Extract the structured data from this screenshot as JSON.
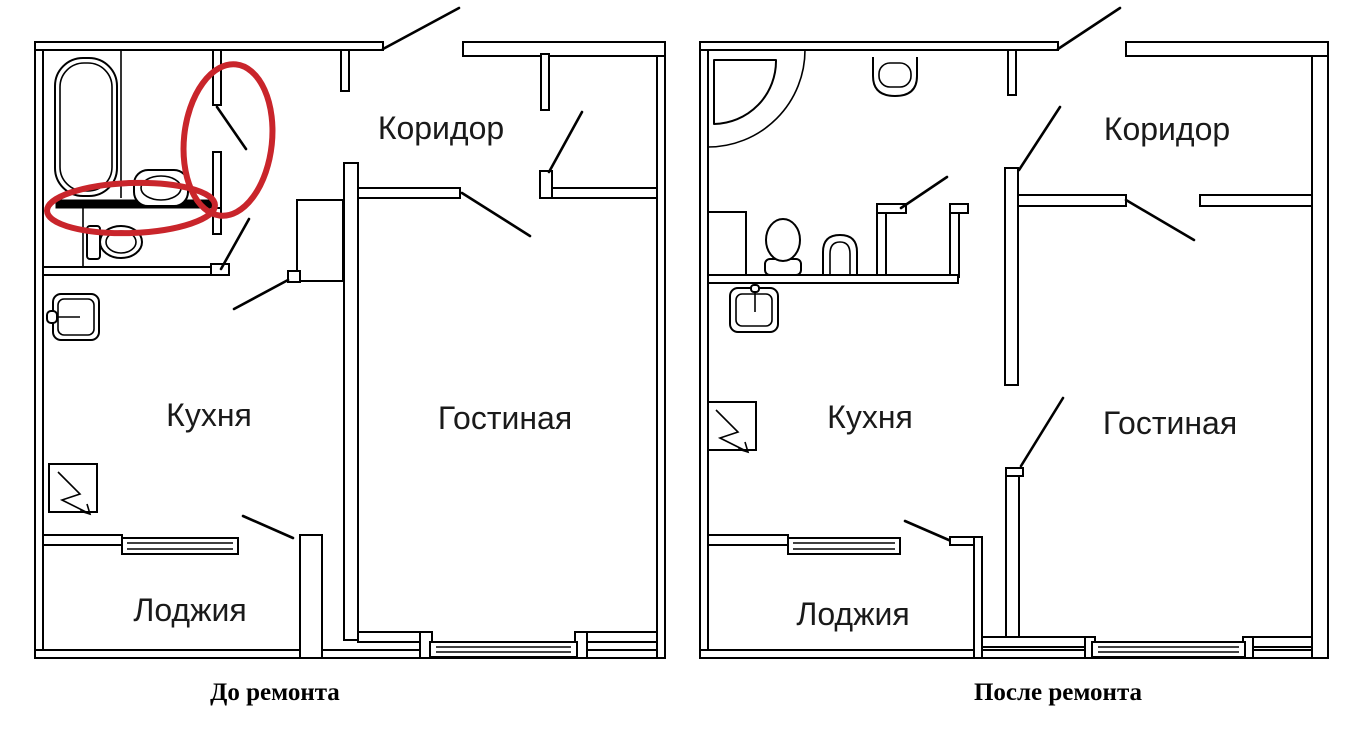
{
  "plans": {
    "before": {
      "caption": "До ремонта",
      "rooms": {
        "corridor": "Коридор",
        "kitchen": "Кухня",
        "living": "Гостиная",
        "loggia": "Лоджия"
      }
    },
    "after": {
      "caption": "После ремонта",
      "rooms": {
        "corridor": "Коридор",
        "kitchen": "Кухня",
        "living": "Гостиная",
        "loggia": "Лоджия"
      }
    }
  },
  "annotations": {
    "highlight_color": "#c9252b",
    "items": [
      "bathroom-door-highlight",
      "bathroom-partition-highlight"
    ]
  },
  "colors": {
    "wall": "#000000",
    "background": "#ffffff",
    "label": "#1a1a1a"
  }
}
